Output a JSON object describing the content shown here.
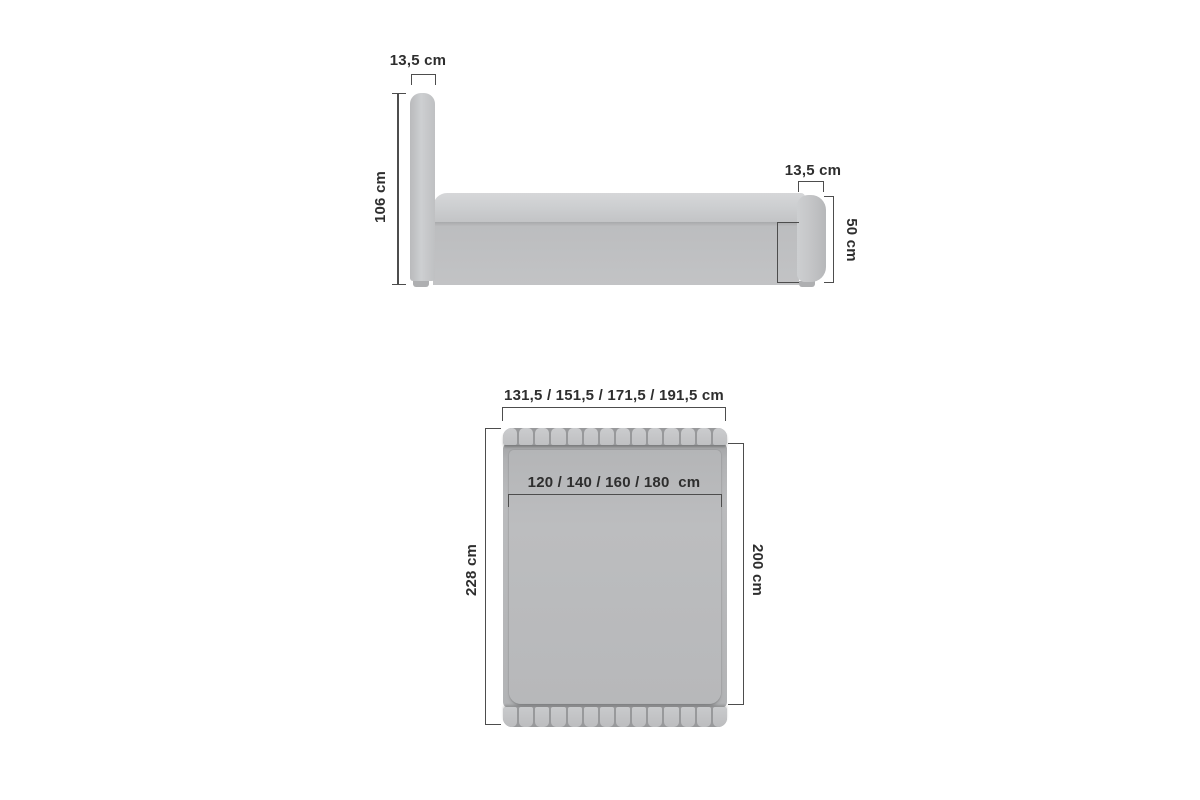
{
  "diagram": {
    "side_view": {
      "headboard_width_label": "13,5 cm",
      "headboard_height_label": "106 cm",
      "footboard_width_label": "13,5 cm",
      "footboard_height_label": "50 cm",
      "base_height_label": "33,5 cm"
    },
    "top_view": {
      "total_width_label": "131,5 / 151,5 / 171,5 / 191,5 cm",
      "mattress_width_label": "120 / 140 / 160 / 180  cm",
      "total_length_label": "228 cm",
      "mattress_length_label": "200 cm"
    }
  },
  "colors": {
    "background": "#ffffff",
    "line": "#4d4d4d",
    "text": "#2e2e2e",
    "fabric": "#c2c3c5",
    "fabric_light": "#cdcfd1",
    "fabric_lighter": "#d6d7d9",
    "fabric_dark": "#b2b3b5",
    "fabric_darker": "#9c9d9f",
    "seam": "#98999b"
  },
  "layout": {
    "headboard_segments": 14,
    "footboard_segments": 14
  }
}
